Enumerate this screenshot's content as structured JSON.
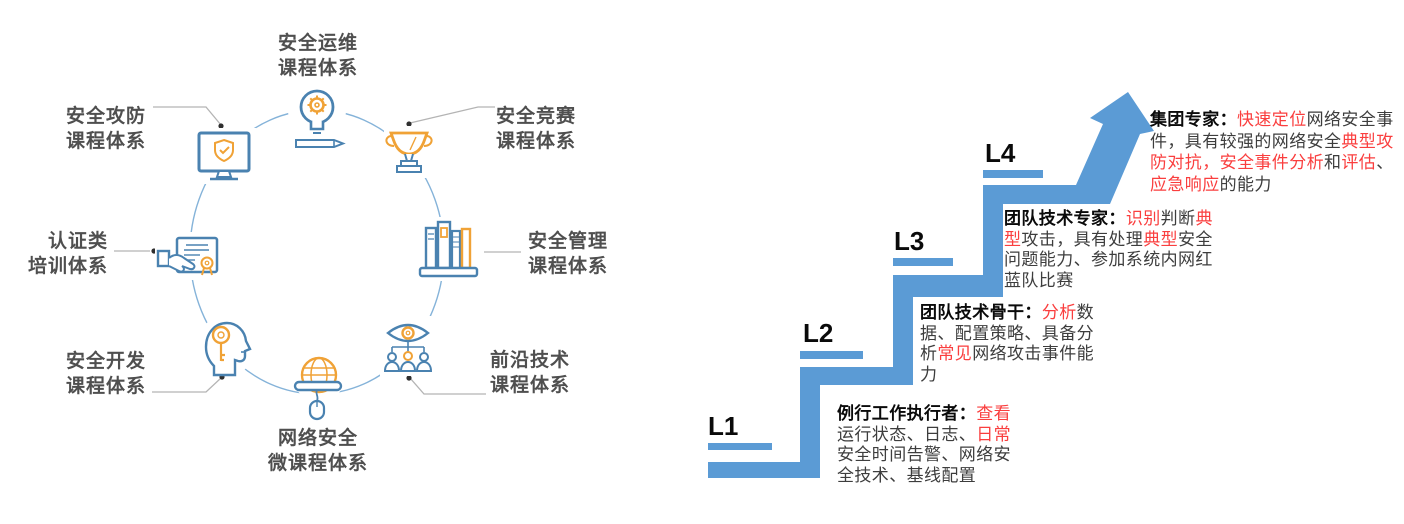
{
  "colors": {
    "stair_blue": "#5B9BD5",
    "red_text": "#fa3e3e",
    "icon_blue": "#4a82b0",
    "icon_orange": "#f0a236",
    "circle_blue": "#85b3d9",
    "connector_gray": "#b4b4b4",
    "body_text": "#3d3d3d",
    "label_gray": "#4f4f4f"
  },
  "diagram": {
    "nodes": [
      {
        "id": "ops",
        "icon": "lightbulb-gear-icon",
        "label_lines": [
          "安全运维",
          "课程体系"
        ]
      },
      {
        "id": "attack-defense",
        "icon": "monitor-shield-icon",
        "label_lines": [
          "安全攻防",
          "课程体系"
        ]
      },
      {
        "id": "competition",
        "icon": "trophy-icon",
        "label_lines": [
          "安全竞赛",
          "课程体系"
        ]
      },
      {
        "id": "certification",
        "icon": "certificate-icon",
        "label_lines": [
          "认证类",
          "培训体系"
        ]
      },
      {
        "id": "management",
        "icon": "books-icon",
        "label_lines": [
          "安全管理",
          "课程体系"
        ]
      },
      {
        "id": "development",
        "icon": "head-key-icon",
        "label_lines": [
          "安全开发",
          "课程体系"
        ]
      },
      {
        "id": "frontier",
        "icon": "eye-people-icon",
        "label_lines": [
          "前沿技术",
          "课程体系"
        ]
      },
      {
        "id": "micro",
        "icon": "globe-mouse-icon",
        "label_lines": [
          "网络安全",
          "微课程体系"
        ]
      }
    ]
  },
  "ladder": {
    "levels": [
      {
        "label": "L1",
        "lines": [
          [
            {
              "t": "例行工作执行者：",
              "s": "b"
            },
            {
              "t": "查看",
              "s": "r"
            }
          ],
          [
            {
              "t": "运行状态、日志、",
              "s": "n"
            },
            {
              "t": "日常",
              "s": "r"
            }
          ],
          [
            {
              "t": "安全时间告警、网络安",
              "s": "n"
            }
          ],
          [
            {
              "t": "全技术、基线配置",
              "s": "n"
            }
          ]
        ]
      },
      {
        "label": "L2",
        "lines": [
          [
            {
              "t": "团队技术骨干：",
              "s": "b"
            },
            {
              "t": "分析",
              "s": "r"
            },
            {
              "t": "数",
              "s": "n"
            }
          ],
          [
            {
              "t": "据、配置策略、具备分",
              "s": "n"
            }
          ],
          [
            {
              "t": "析",
              "s": "n"
            },
            {
              "t": "常见",
              "s": "r"
            },
            {
              "t": "网络攻击事件能",
              "s": "n"
            }
          ],
          [
            {
              "t": "力",
              "s": "n"
            }
          ]
        ]
      },
      {
        "label": "L3",
        "lines": [
          [
            {
              "t": "团队技术专家：",
              "s": "b"
            },
            {
              "t": "识别",
              "s": "r"
            },
            {
              "t": "判断",
              "s": "n"
            },
            {
              "t": "典",
              "s": "r"
            }
          ],
          [
            {
              "t": "型",
              "s": "r"
            },
            {
              "t": "攻击，具有处理",
              "s": "n"
            },
            {
              "t": "典型",
              "s": "r"
            },
            {
              "t": "安全",
              "s": "n"
            }
          ],
          [
            {
              "t": "问题能力、参加系统内网红",
              "s": "n"
            }
          ],
          [
            {
              "t": "蓝队比赛",
              "s": "n"
            }
          ]
        ]
      },
      {
        "label": "L4",
        "lines": [
          [
            {
              "t": "集团专家：",
              "s": "b"
            },
            {
              "t": "快速定位",
              "s": "r"
            },
            {
              "t": "网络安全事",
              "s": "n"
            }
          ],
          [
            {
              "t": "件，具有较强的网络安全",
              "s": "n"
            },
            {
              "t": "典型攻",
              "s": "r"
            }
          ],
          [
            {
              "t": "防对抗，安全事件分析",
              "s": "r"
            },
            {
              "t": "和",
              "s": "n"
            },
            {
              "t": "评估",
              "s": "r"
            },
            {
              "t": "、",
              "s": "n"
            }
          ],
          [
            {
              "t": "应急响应",
              "s": "r"
            },
            {
              "t": "的能力",
              "s": "n"
            }
          ]
        ]
      }
    ]
  }
}
